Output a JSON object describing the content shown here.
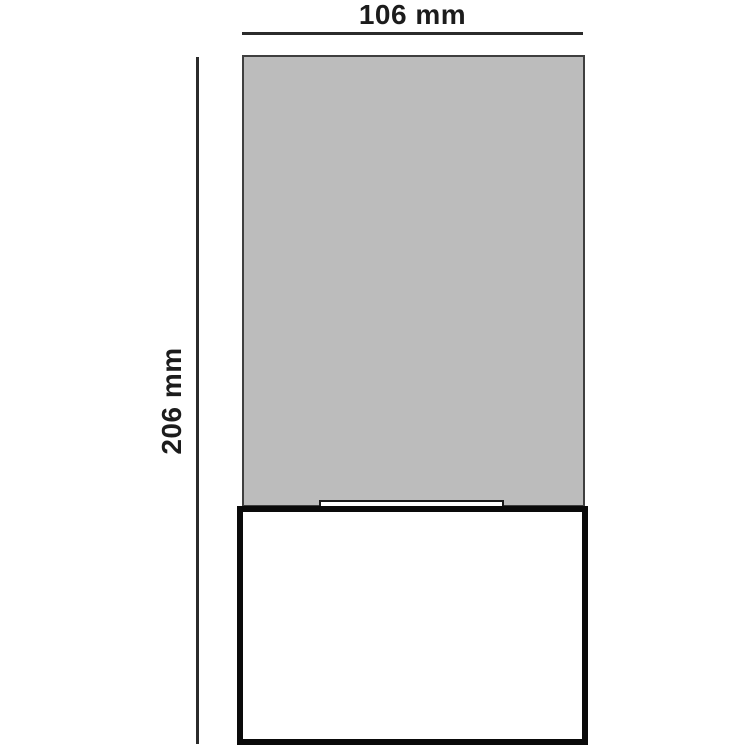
{
  "diagram": {
    "type": "technical-dimension-drawing",
    "width_dimension": {
      "label": "106 mm",
      "value": 106,
      "unit": "mm"
    },
    "height_dimension": {
      "label": "206 mm",
      "value": 206,
      "unit": "mm"
    },
    "parts": {
      "body": "gray rectangular body (shade/upper section)",
      "notch": "small white recessed slot at junction",
      "base": "white base box with thick black outline"
    },
    "colors": {
      "background": "#ffffff",
      "body_fill": "#bcbcbc",
      "body_border": "#3f3f3f",
      "base_fill": "#ffffff",
      "base_border": "#0a0a0a",
      "notch_border": "#1a1a1a",
      "dimension_line": "#2b2b2b",
      "text": "#1c1c1c"
    }
  }
}
